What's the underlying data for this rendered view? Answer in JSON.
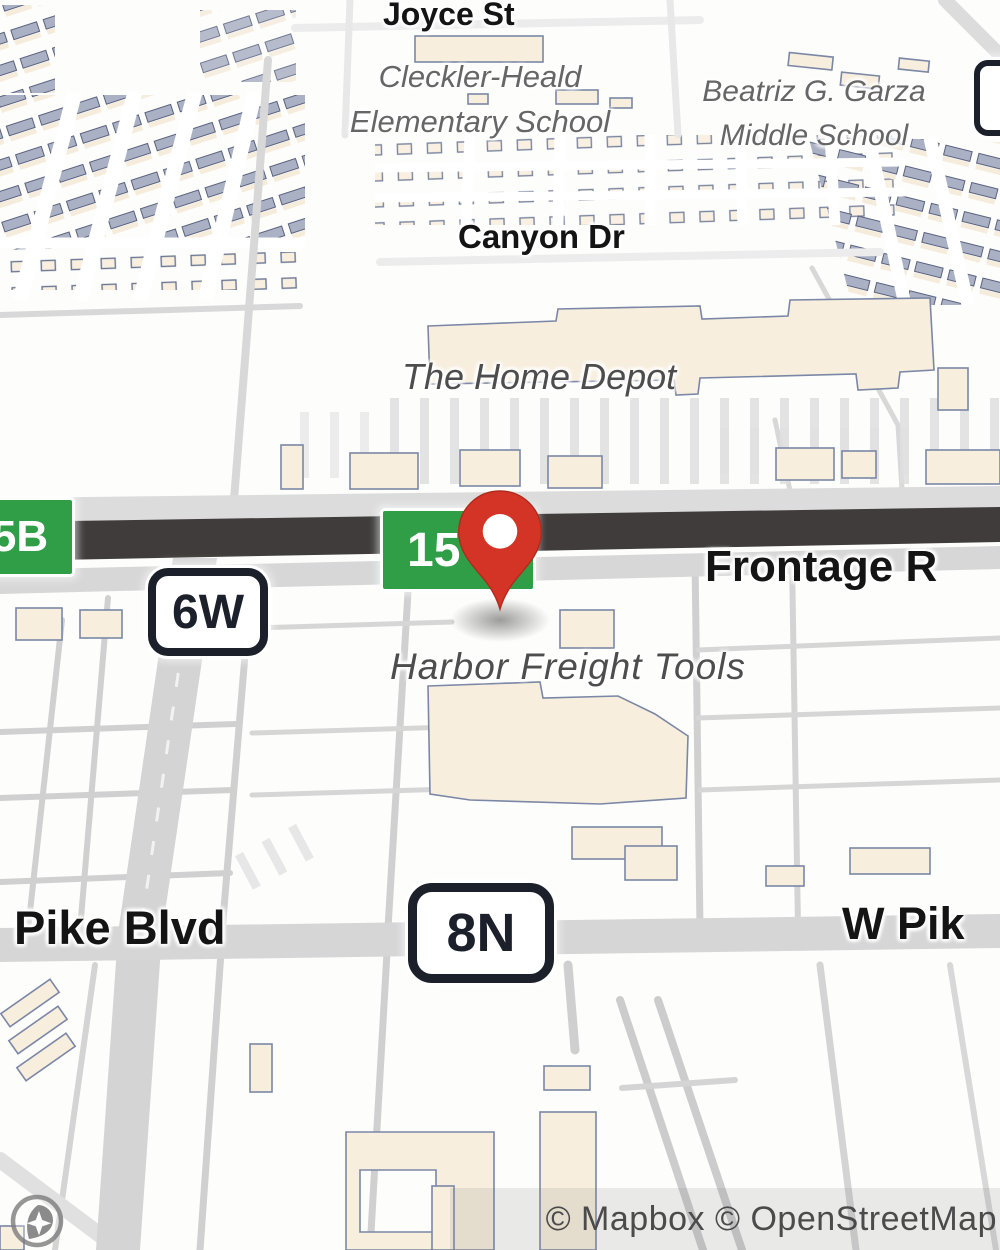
{
  "map": {
    "labels": {
      "joyce_st": "Joyce St",
      "canyon_dr": "Canyon Dr",
      "cleckler_line1": "Cleckler-Heald",
      "cleckler_line2": "Elementary School",
      "garza_line1": "Beatriz G. Garza",
      "garza_line2": "Middle School",
      "home_depot": "The Home Depot",
      "harbor_freight": "Harbor Freight Tools",
      "frontage_rd": "Frontage R",
      "pike_blvd": "Pike Blvd",
      "w_pike": "W Pik"
    },
    "shields": {
      "exit_5b": "5B",
      "route_15": "15",
      "route_5": "5",
      "route_6w": "6W",
      "route_8n": "8N"
    },
    "marker": {
      "icon": "location-pin-icon",
      "color": "#d43425"
    },
    "logo_icon": "mapbox-logo-icon",
    "attribution": "© Mapbox © OpenStreetMap",
    "colors": {
      "shield_green": "#2f9e47",
      "shield_border_dark": "#1b202b",
      "highway_dark": "#403c3b",
      "road_gray": "#d5d5d5",
      "building_fill": "#f7eedd",
      "building_stroke": "#7b87a6",
      "street_label": "#141414",
      "poi_label": "#4d4d4d",
      "school_label": "#666666",
      "attribution_text": "#4b4b4b"
    }
  }
}
